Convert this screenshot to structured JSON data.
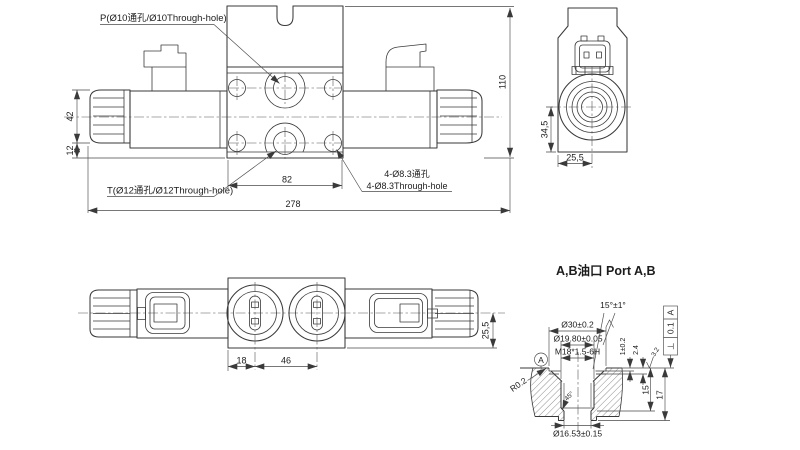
{
  "front_view": {
    "label_p": "P(Ø10通孔/Ø10Through-hole)",
    "label_t": "T(Ø12通孔/Ø12Through-hole)",
    "label_holes_line1": "4-Ø8.3通孔",
    "label_holes_line2": "4-Ø8.3Through-hole",
    "dim_total_height": "110",
    "dim_coil_cap": "42",
    "dim_cap_to_base": "12",
    "dim_bolt_span": "82",
    "dim_total_length": "278"
  },
  "end_view": {
    "dim_center_to_base": "34,5",
    "dim_half_width": "25,5"
  },
  "top_view": {
    "dim_edge_to_port": "18",
    "dim_port_spacing": "46",
    "dim_center_to_edge": "25,5"
  },
  "port_detail": {
    "title": "A,B油口 Port A,B",
    "dim_chamfer_angle": "15°±1°",
    "dim_counterbore": "Ø30±0.2",
    "dim_pilot_bore": "Ø19.80±0.05",
    "dim_thread": "M18*1.5-6H",
    "dim_land_depth": "1±0.2",
    "dim_step_depth": "2.4",
    "roughness": "3.2",
    "dim_thread_depth": "15",
    "dim_total_depth": "17",
    "dim_corner_radius": "R0.2",
    "dim_chamfer": "45°",
    "dim_bore": "Ø16.53±0.15",
    "datum_label": "A",
    "gdt": {
      "symbol": "⊥",
      "tolerance": "0.1",
      "datum": "A"
    }
  }
}
